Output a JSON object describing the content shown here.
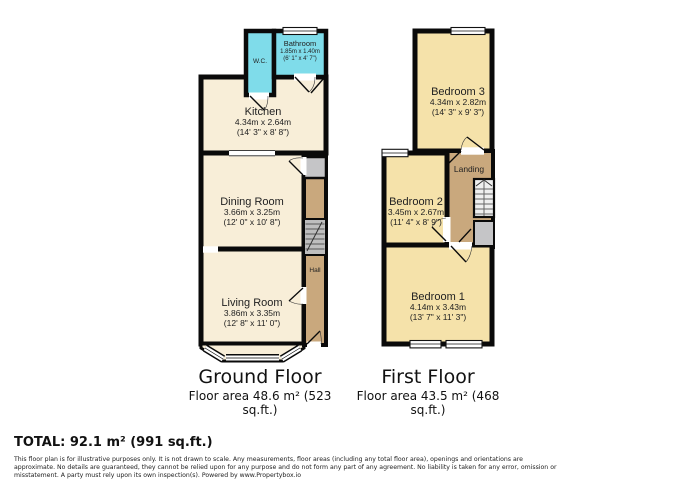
{
  "ground_floor": {
    "title": "Ground Floor",
    "area": "Floor area 48.6 m² (523 sq.ft.)",
    "rooms": {
      "bathroom": {
        "name": "Bathroom",
        "metric": "1.85m x 1.40m",
        "imperial": "(6' 1\" x 4' 7\")"
      },
      "wc": {
        "name": "W.C."
      },
      "kitchen": {
        "name": "Kitchen",
        "metric": "4.34m x 2.64m",
        "imperial": "(14' 3\" x 8' 8\")"
      },
      "dining_room": {
        "name": "Dining Room",
        "metric": "3.66m x 3.25m",
        "imperial": "(12' 0\" x 10' 8\")"
      },
      "living_room": {
        "name": "Living Room",
        "metric": "3.86m x 3.35m",
        "imperial": "(12' 8\" x 11' 0\")"
      },
      "hall": {
        "name": "Hall"
      }
    }
  },
  "first_floor": {
    "title": "First Floor",
    "area": "Floor area 43.5 m² (468 sq.ft.)",
    "rooms": {
      "bedroom3": {
        "name": "Bedroom 3",
        "metric": "4.34m x 2.82m",
        "imperial": "(14' 3\" x 9' 3\")"
      },
      "bedroom2": {
        "name": "Bedroom 2",
        "metric": "3.45m x 2.67m",
        "imperial": "(11' 4\" x 8' 9\")"
      },
      "bedroom1": {
        "name": "Bedroom 1",
        "metric": "4.14m x 3.43m",
        "imperial": "(13' 7\" x 11' 3\")"
      },
      "landing": {
        "name": "Landing"
      }
    }
  },
  "total": "TOTAL: 92.1 m² (991 sq.ft.)",
  "disclaimer": [
    "This floor plan is for illustrative purposes only. It is not drawn to scale. Any measurements, floor areas (including any total floor area), openings and orientations are",
    "approximate. No details are guaranteed, they cannot be relied upon for any purpose and do not form any part of any agreement. No liability is taken for any error, omission or",
    "misstatement. A party must rely upon its own inspection(s). Powered by www.Propertybox.io"
  ],
  "colors": {
    "wall": "#0a0a0a",
    "ground_room_fill": "#F8EED8",
    "bedroom_fill": "#F5E2AA",
    "wet_room_fill": "#7FDCEA",
    "hall_landing_fill": "#C9A87D",
    "cupboard_fill": "#C5C5C7",
    "stairs_fill": "#BEBEBE"
  }
}
